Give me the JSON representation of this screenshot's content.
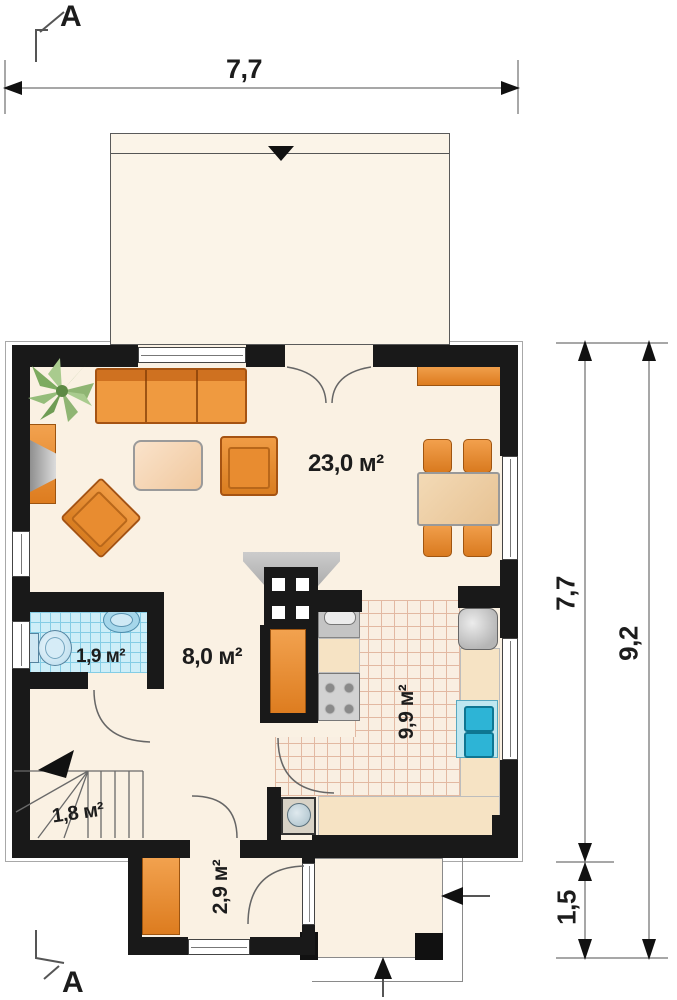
{
  "section": {
    "label": "A"
  },
  "dimensions": {
    "top_width": "7,7",
    "right_height": "7,7",
    "right_total_height": "9,2",
    "right_porch_depth": "1,5"
  },
  "rooms": {
    "living": {
      "area": "23,0 м²"
    },
    "hall": {
      "area": "8,0 м²"
    },
    "bathroom": {
      "area": "1,9 м²"
    },
    "kitchen": {
      "area": "9,9 м²"
    },
    "stairs": {
      "area": "1,8 м²"
    },
    "vestibule": {
      "area": "2,9 м²"
    }
  },
  "colors": {
    "wall": "#191919",
    "floor": "#faf1e3",
    "furniture_orange": "#e6872f",
    "table_tan": "#eccfa6",
    "tile_blue": "#cdeef8",
    "sink_teal": "#35bbd9",
    "dimension_line": "#8a8a8a"
  }
}
